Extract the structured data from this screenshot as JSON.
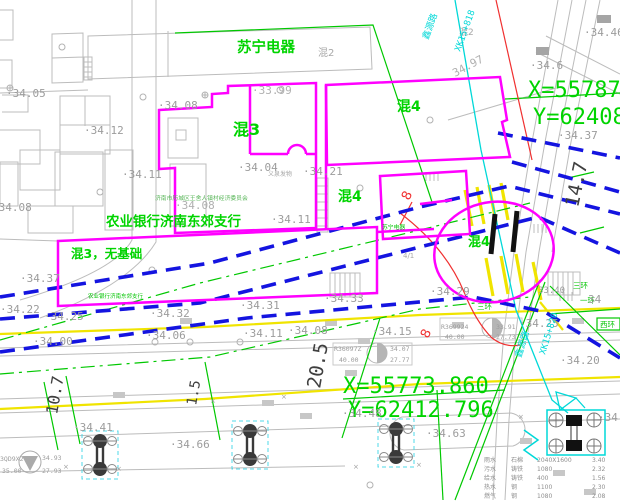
{
  "colors": {
    "gray": "#9c9c9c",
    "dimdark": "#3f3f3f",
    "green": "#00d400",
    "magenta": "#ff00ff",
    "blue": "#1414e0",
    "cyan": "#00d8d8",
    "red": "#f03030",
    "yellow": "#f0e400"
  },
  "coordinates": {
    "point_top_right": {
      "x_label": "X=55787",
      "y_label": "Y=62408"
    },
    "point_bottom": {
      "x_label": "X=55773.860",
      "y_label": "Y=62412.796"
    }
  },
  "legend": {
    "cols_x": [
      484,
      511,
      537,
      592
    ],
    "start_y": 462,
    "row_h": 9,
    "size": 6,
    "color": "#8f8f8f",
    "rows": [
      [
        "雨水",
        "石棉",
        "2040X1600",
        "3.40"
      ],
      [
        "污水",
        "铸铁",
        "1080",
        "2.32"
      ],
      [
        "给水",
        "铸铁",
        "400",
        "1.56"
      ],
      [
        "热水",
        "钢",
        "1100",
        "2.30"
      ],
      [
        "燃气",
        "钢",
        "1080",
        "2.08"
      ]
    ]
  },
  "labels": [
    {
      "text": "苏宁电器",
      "x": 237,
      "y": 52,
      "size": 14.5,
      "color": "#00d400",
      "bold": true,
      "name": "label-suning-store"
    },
    {
      "text": "混3",
      "x": 233,
      "y": 135,
      "size": 16,
      "color": "#00d400",
      "bold": true,
      "name": "label-building-hun3"
    },
    {
      "text": "混4",
      "x": 397,
      "y": 111,
      "size": 14,
      "color": "#00d400",
      "bold": true,
      "name": "label-building-hun4-a"
    },
    {
      "text": "混4",
      "x": 338,
      "y": 201,
      "size": 14,
      "color": "#00d400",
      "bold": true,
      "name": "label-building-hun4-b"
    },
    {
      "text": "混4",
      "x": 468,
      "y": 246,
      "size": 13,
      "color": "#00d400",
      "bold": true,
      "name": "label-building-hun4-c"
    },
    {
      "text": "农业银行济南东郊支行",
      "x": 106,
      "y": 226,
      "size": 13.5,
      "color": "#00d400",
      "bold": true,
      "name": "label-agri-bank"
    },
    {
      "text": "混3，无基础",
      "x": 71,
      "y": 258,
      "size": 12.5,
      "color": "#00d400",
      "bold": true,
      "name": "label-hun3-no-foundation"
    },
    {
      "text": "农业银行济南东郊支行",
      "x": 88,
      "y": 298,
      "size": 5.5,
      "color": "#00c400",
      "name": "label-agri-bank-small"
    },
    {
      "text": "济南市历城区王舍人镇村经济委员会",
      "x": 155,
      "y": 200,
      "size": 5.8,
      "color": "#55b455",
      "name": "label-village-committee"
    },
    {
      "text": "苏宁电器",
      "x": 382,
      "y": 229,
      "size": 5.8,
      "color": "#00c400",
      "name": "label-suning-small"
    },
    {
      "text": "三环",
      "x": 573,
      "y": 288,
      "size": 7.5,
      "color": "#00c400",
      "name": "label-ring3-a"
    },
    {
      "text": "一环",
      "x": 580,
      "y": 303,
      "size": 7.5,
      "color": "#00c400",
      "name": "label-ring1"
    },
    {
      "text": "三环",
      "x": 477,
      "y": 309,
      "size": 7.5,
      "color": "#00c400",
      "name": "label-ring3-b"
    },
    {
      "text": "西环",
      "x": 600,
      "y": 327,
      "size": 7.5,
      "color": "#00c400",
      "name": "label-ring-west"
    },
    {
      "text": "X=55787",
      "x": 528,
      "y": 97,
      "size": 22,
      "color": "#00d400",
      "mono": true,
      "name": "coordinate-x-top"
    },
    {
      "text": "Y=62408",
      "x": 533,
      "y": 124,
      "size": 22,
      "color": "#00d400",
      "mono": true,
      "name": "coordinate-y-top"
    },
    {
      "text": "X=55773.860",
      "x": 343,
      "y": 393,
      "size": 22,
      "color": "#00d400",
      "mono": true,
      "name": "coordinate-x-bottom"
    },
    {
      "text": "Y=62412.796",
      "x": 348,
      "y": 417,
      "size": 22,
      "color": "#00d400",
      "mono": true,
      "name": "coordinate-y-bottom"
    },
    {
      "text": "混2",
      "x": 318,
      "y": 56,
      "size": 10,
      "color": "#a8a8a8",
      "name": "label-building-hun2-a"
    },
    {
      "text": "混2",
      "x": 459,
      "y": 35,
      "size": 9,
      "color": "#a8a8a8",
      "name": "label-building-hun2-b"
    },
    {
      "text": "义泉发物",
      "x": 268,
      "y": 176,
      "size": 6,
      "color": "#a8a8a8",
      "name": "label-yiquan"
    },
    {
      "text": "4/1",
      "x": 403,
      "y": 258,
      "size": 7,
      "color": "#a8a8a8",
      "name": "label-4-1"
    },
    {
      "text": "·34.05",
      "x": 6,
      "y": 97,
      "size": 11,
      "color": "#9c9c9c",
      "mono": true,
      "name": "elevation"
    },
    {
      "text": "·34.08",
      "x": 158,
      "y": 109,
      "size": 11,
      "color": "#9c9c9c",
      "mono": true,
      "name": "elevation"
    },
    {
      "text": "·34.12",
      "x": 84,
      "y": 134,
      "size": 11,
      "color": "#9c9c9c",
      "mono": true,
      "name": "elevation"
    },
    {
      "text": "·33.99",
      "x": 252,
      "y": 94,
      "size": 11,
      "color": "#b0b0b0",
      "mono": true,
      "name": "elevation"
    },
    {
      "text": "·34.46",
      "x": 584,
      "y": 36,
      "size": 11,
      "color": "#9c9c9c",
      "mono": true,
      "name": "elevation"
    },
    {
      "text": "·34.6",
      "x": 530,
      "y": 69,
      "size": 11,
      "color": "#9c9c9c",
      "mono": true,
      "name": "elevation"
    },
    {
      "text": "34.97",
      "x": 455,
      "y": 77,
      "size": 11,
      "color": "#b0b0b0",
      "mono": true,
      "rot": -28,
      "name": "elevation"
    },
    {
      "text": "·34.37",
      "x": 558,
      "y": 139,
      "size": 11,
      "color": "#9c9c9c",
      "mono": true,
      "name": "elevation"
    },
    {
      "text": "·34.11",
      "x": 122,
      "y": 178,
      "size": 11,
      "color": "#9c9c9c",
      "mono": true,
      "name": "elevation"
    },
    {
      "text": "·34.04",
      "x": 238,
      "y": 171,
      "size": 11,
      "color": "#9c9c9c",
      "mono": true,
      "name": "elevation"
    },
    {
      "text": "·34.21",
      "x": 303,
      "y": 175,
      "size": 11,
      "color": "#9c9c9c",
      "mono": true,
      "name": "elevation"
    },
    {
      "text": "·34.11",
      "x": 271,
      "y": 223,
      "size": 11,
      "color": "#9c9c9c",
      "mono": true,
      "name": "elevation"
    },
    {
      "text": "·34.08",
      "x": 175,
      "y": 209,
      "size": 11,
      "color": "#b0b0b0",
      "mono": true,
      "name": "elevation"
    },
    {
      "text": "·34.08",
      "x": -8,
      "y": 211,
      "size": 11,
      "color": "#9c9c9c",
      "mono": true,
      "name": "elevation"
    },
    {
      "text": "·34.37",
      "x": 20,
      "y": 282,
      "size": 11,
      "color": "#9c9c9c",
      "mono": true,
      "name": "elevation"
    },
    {
      "text": "·34.31",
      "x": 240,
      "y": 309,
      "size": 11,
      "color": "#9c9c9c",
      "mono": true,
      "name": "elevation"
    },
    {
      "text": "·34.33",
      "x": 324,
      "y": 302,
      "size": 11,
      "color": "#9c9c9c",
      "mono": true,
      "name": "elevation"
    },
    {
      "text": "·34.29",
      "x": 430,
      "y": 295,
      "size": 11,
      "color": "#9c9c9c",
      "mono": true,
      "name": "elevation"
    },
    {
      "text": "·34.25",
      "x": 519,
      "y": 327,
      "size": 11,
      "color": "#9c9c9c",
      "mono": true,
      "name": "elevation"
    },
    {
      "text": "·34.22",
      "x": 0,
      "y": 313,
      "size": 11,
      "color": "#9c9c9c",
      "mono": true,
      "name": "elevation"
    },
    {
      "text": "·34.25",
      "x": 44,
      "y": 320,
      "size": 11,
      "color": "#9c9c9c",
      "mono": true,
      "name": "elevation"
    },
    {
      "text": "·34.32",
      "x": 150,
      "y": 317,
      "size": 11,
      "color": "#9c9c9c",
      "mono": true,
      "name": "elevation"
    },
    {
      "text": "·34.00",
      "x": 33,
      "y": 345,
      "size": 11,
      "color": "#9c9c9c",
      "mono": true,
      "name": "elevation"
    },
    {
      "text": "·34.06",
      "x": 146,
      "y": 339,
      "size": 11,
      "color": "#9c9c9c",
      "mono": true,
      "name": "elevation"
    },
    {
      "text": "·34.41",
      "x": 73,
      "y": 431,
      "size": 11,
      "color": "#9c9c9c",
      "mono": true,
      "name": "elevation"
    },
    {
      "text": "·34.66",
      "x": 170,
      "y": 448,
      "size": 11,
      "color": "#9c9c9c",
      "mono": true,
      "name": "elevation"
    },
    {
      "text": "·34.11",
      "x": 243,
      "y": 337,
      "size": 11,
      "color": "#9c9c9c",
      "mono": true,
      "name": "elevation"
    },
    {
      "text": "·34.08",
      "x": 288,
      "y": 334,
      "size": 11,
      "color": "#9c9c9c",
      "mono": true,
      "name": "elevation"
    },
    {
      "text": "·34.15",
      "x": 372,
      "y": 335,
      "size": 11,
      "color": "#9c9c9c",
      "mono": true,
      "name": "elevation"
    },
    {
      "text": "·34.48",
      "x": 342,
      "y": 417,
      "size": 11,
      "color": "#9c9c9c",
      "mono": true,
      "name": "elevation"
    },
    {
      "text": "·34.63",
      "x": 426,
      "y": 437,
      "size": 11,
      "color": "#9c9c9c",
      "mono": true,
      "name": "elevation"
    },
    {
      "text": "·34.20",
      "x": 560,
      "y": 364,
      "size": 11,
      "color": "#9c9c9c",
      "mono": true,
      "name": "elevation"
    },
    {
      "text": "34",
      "x": 588,
      "y": 303,
      "size": 11,
      "color": "#9c9c9c",
      "mono": true,
      "name": "elevation"
    },
    {
      "text": "·34",
      "x": 598,
      "y": 421,
      "size": 11,
      "color": "#9c9c9c",
      "mono": true,
      "name": "elevation"
    },
    {
      "text": "33.40",
      "x": 538,
      "y": 293,
      "size": 9,
      "color": "#9c9c9c",
      "mono": true,
      "name": "elevation"
    },
    {
      "text": "10.7",
      "x": 57,
      "y": 415,
      "size": 16,
      "color": "#3f3f3f",
      "mono": true,
      "rot": -80,
      "name": "dimension-10-7"
    },
    {
      "text": "1.5",
      "x": 196,
      "y": 406,
      "size": 14,
      "color": "#3f3f3f",
      "mono": true,
      "rot": -80,
      "name": "dimension-1-5"
    },
    {
      "text": "20.5",
      "x": 320,
      "y": 389,
      "size": 19,
      "color": "#3f3f3f",
      "mono": true,
      "rot": -80,
      "name": "dimension-20-5"
    },
    {
      "text": "14.7",
      "x": 578,
      "y": 208,
      "size": 19,
      "color": "#3f3f3f",
      "mono": true,
      "rot": -78,
      "name": "dimension-14-7"
    },
    {
      "text": "鑫源路",
      "x": 428,
      "y": 40,
      "size": 9,
      "color": "#00d8d8",
      "rot": -70,
      "name": "label-road-xinyuan-top"
    },
    {
      "text": "XK15+818",
      "x": 460,
      "y": 52,
      "size": 9,
      "color": "#00d8d8",
      "mono": true,
      "rot": -70,
      "name": "chainage-top"
    },
    {
      "text": "鑫源路",
      "x": 521,
      "y": 358,
      "size": 9,
      "color": "#00d8d8",
      "rot": -73,
      "name": "label-road-xinyuan-bottom"
    },
    {
      "text": "XK15+820",
      "x": 545,
      "y": 355,
      "size": 9,
      "color": "#00d8d8",
      "mono": true,
      "rot": -73,
      "name": "chainage-bottom"
    },
    {
      "text": "8",
      "x": 409,
      "y": 201,
      "size": 13,
      "color": "#f03030",
      "rot": -65,
      "name": "label-red-8-a"
    },
    {
      "text": "8",
      "x": 428,
      "y": 339,
      "size": 13,
      "color": "#f03030",
      "rot": -65,
      "name": "label-red-8-b"
    },
    {
      "text": "3QD9X2",
      "x": 0,
      "y": 461,
      "size": 6.5,
      "color": "#9c9c9c",
      "mono": true,
      "name": "benchmark-id"
    },
    {
      "text": "34.93",
      "x": 42,
      "y": 460,
      "size": 6.5,
      "color": "#9c9c9c",
      "mono": true,
      "name": "benchmark-value"
    },
    {
      "text": "35.00",
      "x": 2,
      "y": 473,
      "size": 6.5,
      "color": "#9c9c9c",
      "mono": true,
      "name": "benchmark-value"
    },
    {
      "text": "27.93",
      "x": 42,
      "y": 473,
      "size": 6.5,
      "color": "#9c9c9c",
      "mono": true,
      "name": "benchmark-value"
    },
    {
      "text": "R36097Z",
      "x": 334,
      "y": 351,
      "size": 6.5,
      "color": "#9c9c9c",
      "mono": true,
      "name": "benchmark-id"
    },
    {
      "text": "34.07",
      "x": 390,
      "y": 351,
      "size": 6.5,
      "color": "#9c9c9c",
      "mono": true,
      "name": "benchmark-value"
    },
    {
      "text": "40.00",
      "x": 339,
      "y": 362,
      "size": 6.5,
      "color": "#9c9c9c",
      "mono": true,
      "name": "benchmark-value"
    },
    {
      "text": "27.77",
      "x": 390,
      "y": 362,
      "size": 6.5,
      "color": "#9c9c9c",
      "mono": true,
      "name": "benchmark-value"
    },
    {
      "text": "R369924",
      "x": 441,
      "y": 329,
      "size": 6.5,
      "color": "#9c9c9c",
      "mono": true,
      "name": "benchmark-id"
    },
    {
      "text": "33.91",
      "x": 496,
      "y": 329,
      "size": 6.5,
      "color": "#9c9c9c",
      "mono": true,
      "name": "benchmark-value"
    },
    {
      "text": "40.00",
      "x": 445,
      "y": 339,
      "size": 6.5,
      "color": "#9c9c9c",
      "mono": true,
      "name": "benchmark-value"
    },
    {
      "text": "27.73",
      "x": 496,
      "y": 339,
      "size": 6.5,
      "color": "#9c9c9c",
      "mono": true,
      "name": "benchmark-value"
    },
    {
      "text": "×",
      "x": 63,
      "y": 469,
      "size": 7,
      "color": "#9c9c9c",
      "name": "survey-cross"
    },
    {
      "text": "×",
      "x": 116,
      "y": 471,
      "size": 7,
      "color": "#9c9c9c",
      "name": "survey-cross"
    },
    {
      "text": "×",
      "x": 210,
      "y": 403,
      "size": 7,
      "color": "#9c9c9c",
      "name": "survey-cross"
    },
    {
      "text": "×",
      "x": 353,
      "y": 469,
      "size": 7,
      "color": "#9c9c9c",
      "name": "survey-cross"
    },
    {
      "text": "×",
      "x": 416,
      "y": 467,
      "size": 7,
      "color": "#9c9c9c",
      "name": "survey-cross"
    },
    {
      "text": "×",
      "x": 281,
      "y": 399,
      "size": 7,
      "color": "#9c9c9c",
      "name": "survey-cross"
    },
    {
      "text": "×",
      "x": 518,
      "y": 419,
      "size": 7,
      "color": "#9c9c9c",
      "name": "survey-cross"
    }
  ]
}
